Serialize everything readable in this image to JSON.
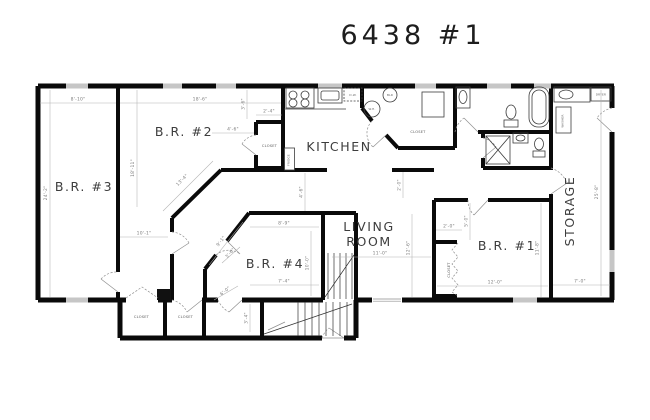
{
  "title": "6438 #1",
  "rooms": {
    "br3": "B.R. #3",
    "br2": "B.R. #2",
    "br4": "B.R. #4",
    "br1": "B.R. #1",
    "kitchen": "KITCHEN",
    "living_line1": "LIVING",
    "living_line2": "ROOM",
    "storage": "STORAGE"
  },
  "fixtures": {
    "closet": "CLOSET",
    "dishwasher": "D.W.",
    "boiler": "BLR",
    "water_heater": "W.H.",
    "washer": "WASHER",
    "dryer": "DRYER",
    "fridge": "FRIDGE"
  },
  "dimensions": {
    "br3_width": "8'-10\"",
    "br3_height": "24'-2\"",
    "br2_width": "18'-6\"",
    "br2_height": "18'-11\"",
    "br2_closet_width": "2'-4\"",
    "br2_closet_offset": "4'-6\"",
    "br2_closet_side": "3'-6\"",
    "br2_diag": "13'-4\"",
    "br2_lower_width": "10'-1\"",
    "hall_diag": "3'-6\"",
    "hall_width": "6'-0\"",
    "hall_depth": "3'-4\"",
    "br4_width": "8'-9\"",
    "br4_height": "10'-0\"",
    "br4_bottom_width": "7'-4\"",
    "br4_diag": "9'-1\"",
    "living_offset": "4'-6\"",
    "living_nook": "2'-0\"",
    "living_width": "11'-0\"",
    "living_height": "12'-6\"",
    "br1_closet_width": "2'-0\"",
    "br1_closet_offset": "5'-0\"",
    "br1_width": "12'-0\"",
    "br1_height": "11'-8\"",
    "storage_width": "7'-0\"",
    "storage_height": "25'-8\""
  }
}
